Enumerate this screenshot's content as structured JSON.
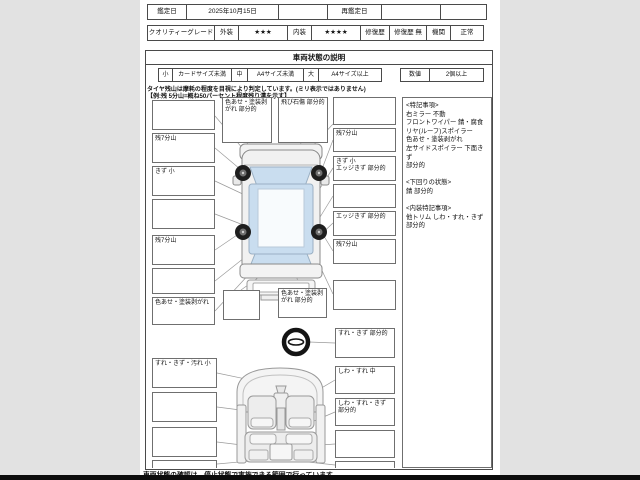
{
  "header": {
    "appraisal_date_label": "鑑定日",
    "appraisal_date_value": "2025年10月15日",
    "reappraisal_date_label": "再鑑定日",
    "quality_grade_label": "クオリティーグレード",
    "exterior_label": "外装",
    "exterior_stars": "★★★",
    "interior_label": "内装",
    "interior_stars": "★★★★",
    "repair_label": "修復歴",
    "repair_value": "修復歴 無",
    "engine_label": "機関",
    "engine_value": "正常"
  },
  "section": {
    "title": "車両状態の説明",
    "legend": {
      "small_key": "小",
      "small_value": "カードサイズ未満",
      "medium_key": "中",
      "medium_value": "A4サイズ未満",
      "large_key": "大",
      "large_value": "A4サイズ以上",
      "count_key": "数値",
      "count_value": "2個以上"
    },
    "note_line1": "タイヤ残山は摩耗の程度を目視により判定しています。(ミリ表示ではありません)",
    "note_line2": "【例:残 5分山=概ね50パーセント程度残り溝を示す】"
  },
  "callouts": {
    "top_roof": "色あせ・塗装剥がれ 部分的",
    "top_windshield": "飛び石傷 部分的",
    "left_1": "",
    "left_2": "残7分山",
    "left_3": "きず 小",
    "left_4": "",
    "left_5": "残7分山",
    "left_6": "",
    "left_7": "色あせ・塗装剥がれ",
    "left_8": "すれ・きず・汚れ 小",
    "left_9": "",
    "left_10": "",
    "left_11": "",
    "mid_1": "",
    "mid_2": "色あせ・塗装剥がれ 部分的",
    "right_1": "",
    "right_2": "残7分山",
    "right_3": "きず 小\nエッジきず 部分的",
    "right_4": "",
    "right_5": "エッジきず 部分的",
    "right_6": "残7分山",
    "right_7": "",
    "right_8": "すれ・きず 部分的",
    "right_9": "しわ・すれ 中",
    "right_10": "しわ・すれ・きず 部分的",
    "right_11": "",
    "right_12": ""
  },
  "remarks_panel": {
    "text": "<特記事項>\n右ミラー 不動\nフロントワイパー 錆・腐食\nリヤ(ルーフ)スポイラー\n色あせ・塗装剥がれ\n左サイドスポイラー 下面きず\n部分的\n\n<下回りの状態>\n錆 部分的\n\n<内装特記事項>\n他トリム しわ・すれ・きず 部分的"
  },
  "footer": {
    "text": "車両状態の確認は、停止状態で実施できる範囲で行っています。"
  },
  "colors": {
    "window_blue": "#c9ddef",
    "page_bg": "#ffffff",
    "margin_gray": "#e2e2e2"
  }
}
